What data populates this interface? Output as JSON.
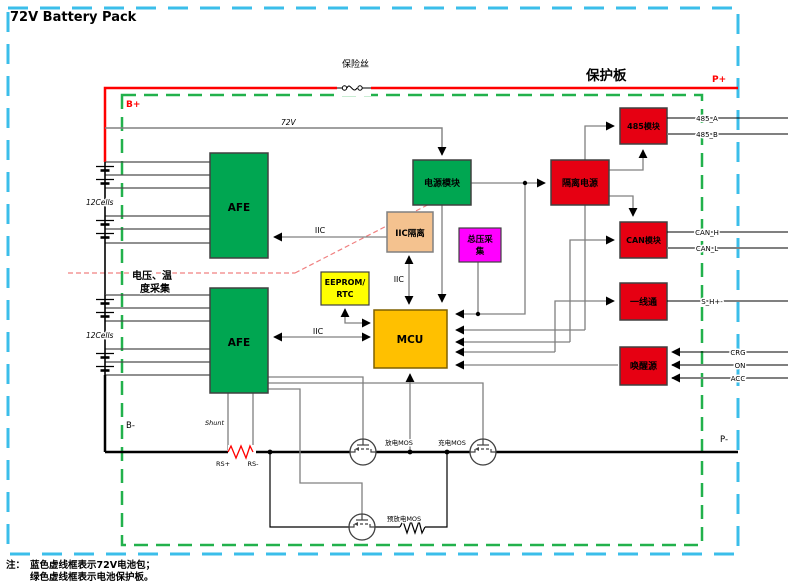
{
  "title": "72V Battery Pack",
  "annotations": {
    "fuse": "保险丝",
    "board": "保护板",
    "sampling_line1": "电压、温",
    "sampling_line2": "度采集",
    "note_prefix": "注：",
    "note_line1": "蓝色虚线框表示72V电池包；",
    "note_line2": "绿色虚线框表示电池保护板。"
  },
  "net_labels": {
    "b_plus": "B+",
    "p_plus": "P+",
    "b_minus": "B-",
    "p_minus": "P-",
    "v72": "72V",
    "iic_afe1": "IIC",
    "iic_afe2": "IIC",
    "iic_mcu": "IIC",
    "cells_top": "12Cells",
    "cells_bottom": "12Cells",
    "shunt": "Shunt",
    "rs_plus": "RS+",
    "rs_minus": "RS-",
    "mos_discharge": "放电MOS",
    "mos_charge": "充电MOS",
    "mos_pre": "预放电MOS"
  },
  "blocks": {
    "afe1": "AFE",
    "afe2": "AFE",
    "power": "电源模块",
    "iso_power": "隔离电源",
    "iic_iso": "IIC隔离",
    "total_voltage_line1": "总压采",
    "total_voltage_line2": "集",
    "eeprom_line1": "EEPROM/",
    "eeprom_line2": "RTC",
    "mcu": "MCU",
    "mod485": "485模块",
    "can": "CAN模块",
    "onewire": "一线通",
    "wake": "唤醒源"
  },
  "ports": {
    "a485": "485_A",
    "b485": "485_B",
    "can_h": "CAN_H",
    "can_l": "CAN_L",
    "s_line": "S_H+-",
    "chg": "CRG",
    "on": "ON",
    "acc": "ACC"
  },
  "colors": {
    "pack_border_cyan": "#3BBEEA",
    "board_border_green": "#22B14C",
    "block_green": "#00A651",
    "block_red": "#E60012",
    "block_salmon": "#F4C28F",
    "block_magenta": "#FF00FF",
    "block_yellow": "#FFFF00",
    "block_gold": "#FFC000",
    "wire_red": "#FF0000",
    "wire_gray": "#808080"
  }
}
